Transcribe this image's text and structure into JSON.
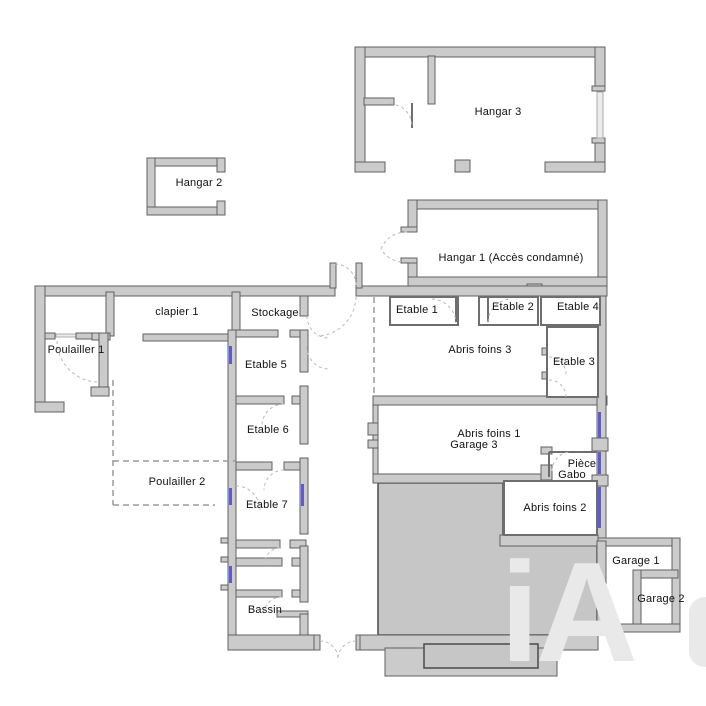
{
  "plan": {
    "labels": {
      "hangar3": "Hangar 3",
      "hangar2": "Hangar 2",
      "hangar1": "Hangar 1 (Accès condamné)",
      "clapier1": "clapier 1",
      "stockage": "Stockage",
      "poulailler1": "Poulailler 1",
      "etable5": "Etable 5",
      "etable1": "Etable 1",
      "etable2": "Etable 2",
      "etable4": "Etable 4",
      "abris_foins3": "Abris foins 3",
      "etable3": "Etable 3",
      "abris_foins1": "Abris foins 1",
      "garage3": "Garage 3",
      "piece": "Pièce",
      "gabo": "Gabo",
      "abris_foins2": "Abris foins 2",
      "etable6": "Etable 6",
      "poulailler2": "Poulailler 2",
      "etable7": "Etable 7",
      "bassin": "Bassin",
      "garage1": "Garage 1",
      "garage2": "Garage 2"
    },
    "watermark": "iA",
    "colors": {
      "background": "#ffffff",
      "wall_fill": "#cbcbcb",
      "wall_stroke": "#606060",
      "thin_stroke": "#6e6e6e",
      "ground_fill": "#c6c6c6",
      "ground_stroke": "#4a4a4a",
      "window_blue": "#5b5bd6",
      "dashed_line": "#9a9a9a",
      "watermark": "#e9e9e9",
      "label_color": "#111111"
    }
  }
}
